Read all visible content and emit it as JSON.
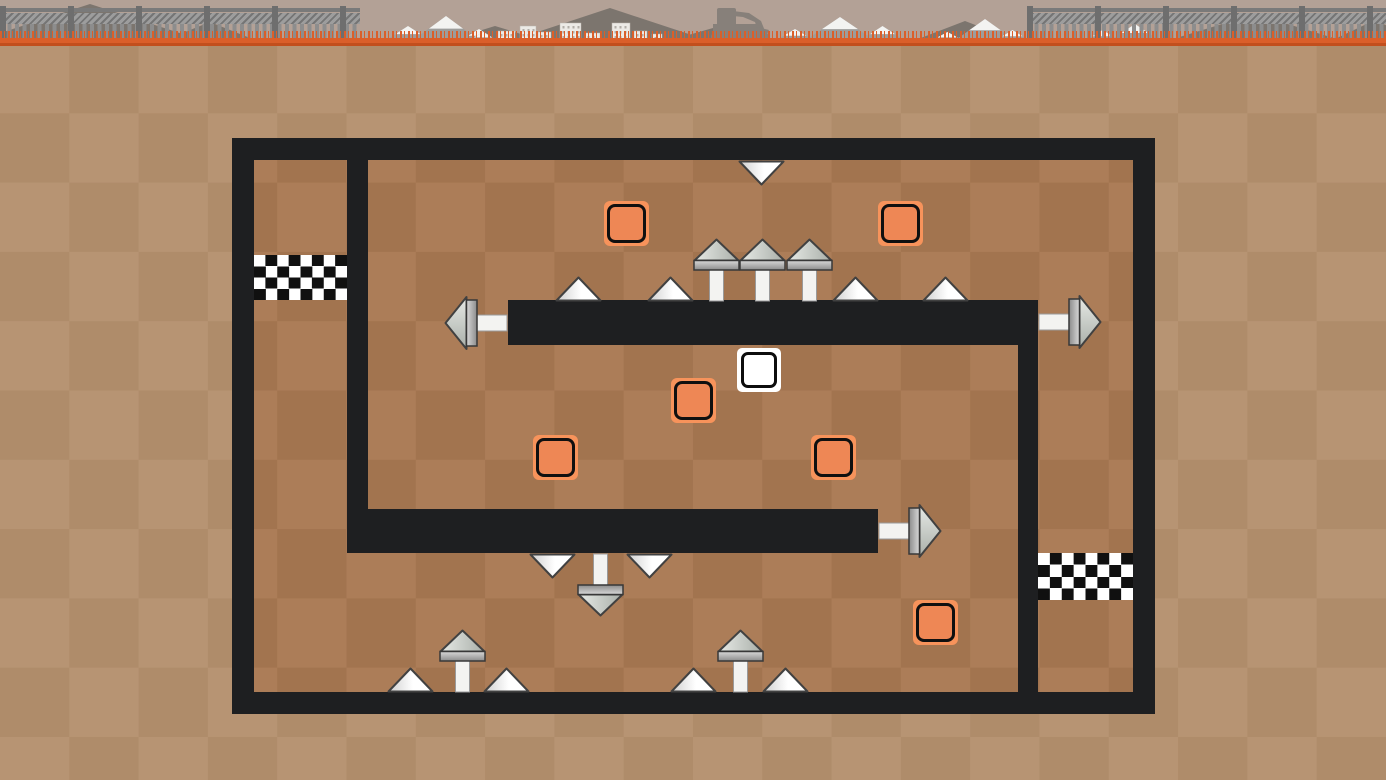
{
  "scene": {
    "colors": {
      "sky": "#b3a196",
      "grass": "#da5f2a",
      "grass_dark": "#c24f1d",
      "dirt_light": "#b79473",
      "dirt_dark": "#af8c6a",
      "maze_dirt_light": "#ac7d58",
      "maze_dirt_dark": "#a2744f",
      "wall": "#1e1f21",
      "crate_fill": "#ee8755",
      "crate_frame": "#f7935b",
      "mountain": "#7c756e",
      "snow_body": "#9d9d9b",
      "snow_cap": "#f3f3f1",
      "building": "#eceae6",
      "building_window": "#b2aea8",
      "machine": "#87807a"
    },
    "backdrop": {
      "fences": [
        {
          "x": 0,
          "w": 360
        },
        {
          "x": 1027,
          "w": 359
        }
      ],
      "dark_mountains": [
        {
          "x": -40,
          "w": 260,
          "h": 42
        },
        {
          "x": 150,
          "w": 120,
          "h": 24
        },
        {
          "x": 430,
          "w": 130,
          "h": 20
        },
        {
          "x": 495,
          "w": 230,
          "h": 38
        },
        {
          "x": 650,
          "w": 140,
          "h": 20
        },
        {
          "x": 900,
          "w": 130,
          "h": 25
        },
        {
          "x": 1150,
          "w": 210,
          "h": 32
        },
        {
          "x": 1320,
          "w": 110,
          "h": 26
        }
      ],
      "snow_mountains": [
        {
          "x": 380,
          "w": 56,
          "h": 18
        },
        {
          "x": 408,
          "w": 76,
          "h": 28
        },
        {
          "x": 455,
          "w": 48,
          "h": 15
        },
        {
          "x": 463,
          "w": 40,
          "h": 12
        },
        {
          "x": 770,
          "w": 50,
          "h": 15
        },
        {
          "x": 800,
          "w": 80,
          "h": 27
        },
        {
          "x": 855,
          "w": 55,
          "h": 18
        },
        {
          "x": 925,
          "w": 45,
          "h": 12
        },
        {
          "x": 950,
          "w": 70,
          "h": 25
        },
        {
          "x": 990,
          "w": 45,
          "h": 14
        },
        {
          "x": 1080,
          "w": 45,
          "h": 14
        },
        {
          "x": 1105,
          "w": 60,
          "h": 20
        }
      ],
      "buildings": [
        {
          "x": 498,
          "w": 17,
          "h": 11
        },
        {
          "x": 520,
          "w": 16,
          "h": 16
        },
        {
          "x": 538,
          "w": 13,
          "h": 10
        },
        {
          "x": 560,
          "w": 21,
          "h": 19
        },
        {
          "x": 585,
          "w": 15,
          "h": 9
        },
        {
          "x": 612,
          "w": 18,
          "h": 19
        },
        {
          "x": 634,
          "w": 13,
          "h": 11
        },
        {
          "x": 652,
          "w": 10,
          "h": 8
        }
      ],
      "excavator": {
        "x": 709,
        "y": 5,
        "w": 66,
        "h": 37
      }
    },
    "level": {
      "interior": {
        "x": 254,
        "y": 160,
        "w": 879,
        "h": 532
      },
      "walls": [
        {
          "x": 232,
          "y": 138,
          "w": 923,
          "h": 22
        },
        {
          "x": 232,
          "y": 692,
          "w": 923,
          "h": 22
        },
        {
          "x": 232,
          "y": 138,
          "w": 22,
          "h": 576
        },
        {
          "x": 1133,
          "y": 138,
          "w": 22,
          "h": 576
        },
        {
          "x": 347,
          "y": 160,
          "w": 21,
          "h": 393
        },
        {
          "x": 347,
          "y": 509,
          "w": 531,
          "h": 44
        },
        {
          "x": 508,
          "y": 300,
          "w": 530,
          "h": 45
        },
        {
          "x": 1018,
          "y": 300,
          "w": 20,
          "h": 392
        }
      ],
      "goals": [
        {
          "x": 254,
          "y": 255,
          "w": 93,
          "h": 45
        },
        {
          "x": 1038,
          "y": 553,
          "w": 95,
          "h": 47
        }
      ],
      "player": {
        "x": 737,
        "y": 348,
        "size": 44
      },
      "crates": [
        {
          "x": 604,
          "y": 201
        },
        {
          "x": 878,
          "y": 201
        },
        {
          "x": 671,
          "y": 378
        },
        {
          "x": 533,
          "y": 435
        },
        {
          "x": 811,
          "y": 435
        },
        {
          "x": 913,
          "y": 600
        }
      ],
      "crate_size": 45,
      "spikes": [
        {
          "type": "triangle",
          "dir": "down",
          "x": 738,
          "y": 160
        },
        {
          "type": "triangle",
          "dir": "up",
          "x": 555,
          "y": 276
        },
        {
          "type": "triangle",
          "dir": "up",
          "x": 647,
          "y": 276
        },
        {
          "type": "pin",
          "dir": "up",
          "x": 693,
          "y": 238
        },
        {
          "type": "pin",
          "dir": "up",
          "x": 739,
          "y": 238
        },
        {
          "type": "pin",
          "dir": "up",
          "x": 786,
          "y": 238
        },
        {
          "type": "triangle",
          "dir": "up",
          "x": 832,
          "y": 276
        },
        {
          "type": "triangle",
          "dir": "up",
          "x": 922,
          "y": 276
        },
        {
          "type": "pin",
          "dir": "left",
          "x": 444,
          "y": 295
        },
        {
          "type": "pin",
          "dir": "right",
          "x": 1038,
          "y": 294
        },
        {
          "type": "pin",
          "dir": "right",
          "x": 878,
          "y": 503
        },
        {
          "type": "triangle",
          "dir": "down",
          "x": 529,
          "y": 553
        },
        {
          "type": "pin",
          "dir": "down",
          "x": 577,
          "y": 553
        },
        {
          "type": "triangle",
          "dir": "down",
          "x": 626,
          "y": 553
        },
        {
          "type": "triangle",
          "dir": "up",
          "x": 387,
          "y": 667
        },
        {
          "type": "pin",
          "dir": "up",
          "x": 439,
          "y": 629
        },
        {
          "type": "triangle",
          "dir": "up",
          "x": 483,
          "y": 667
        },
        {
          "type": "triangle",
          "dir": "up",
          "x": 670,
          "y": 667
        },
        {
          "type": "pin",
          "dir": "up",
          "x": 717,
          "y": 629
        },
        {
          "type": "triangle",
          "dir": "up",
          "x": 762,
          "y": 667
        }
      ]
    }
  }
}
